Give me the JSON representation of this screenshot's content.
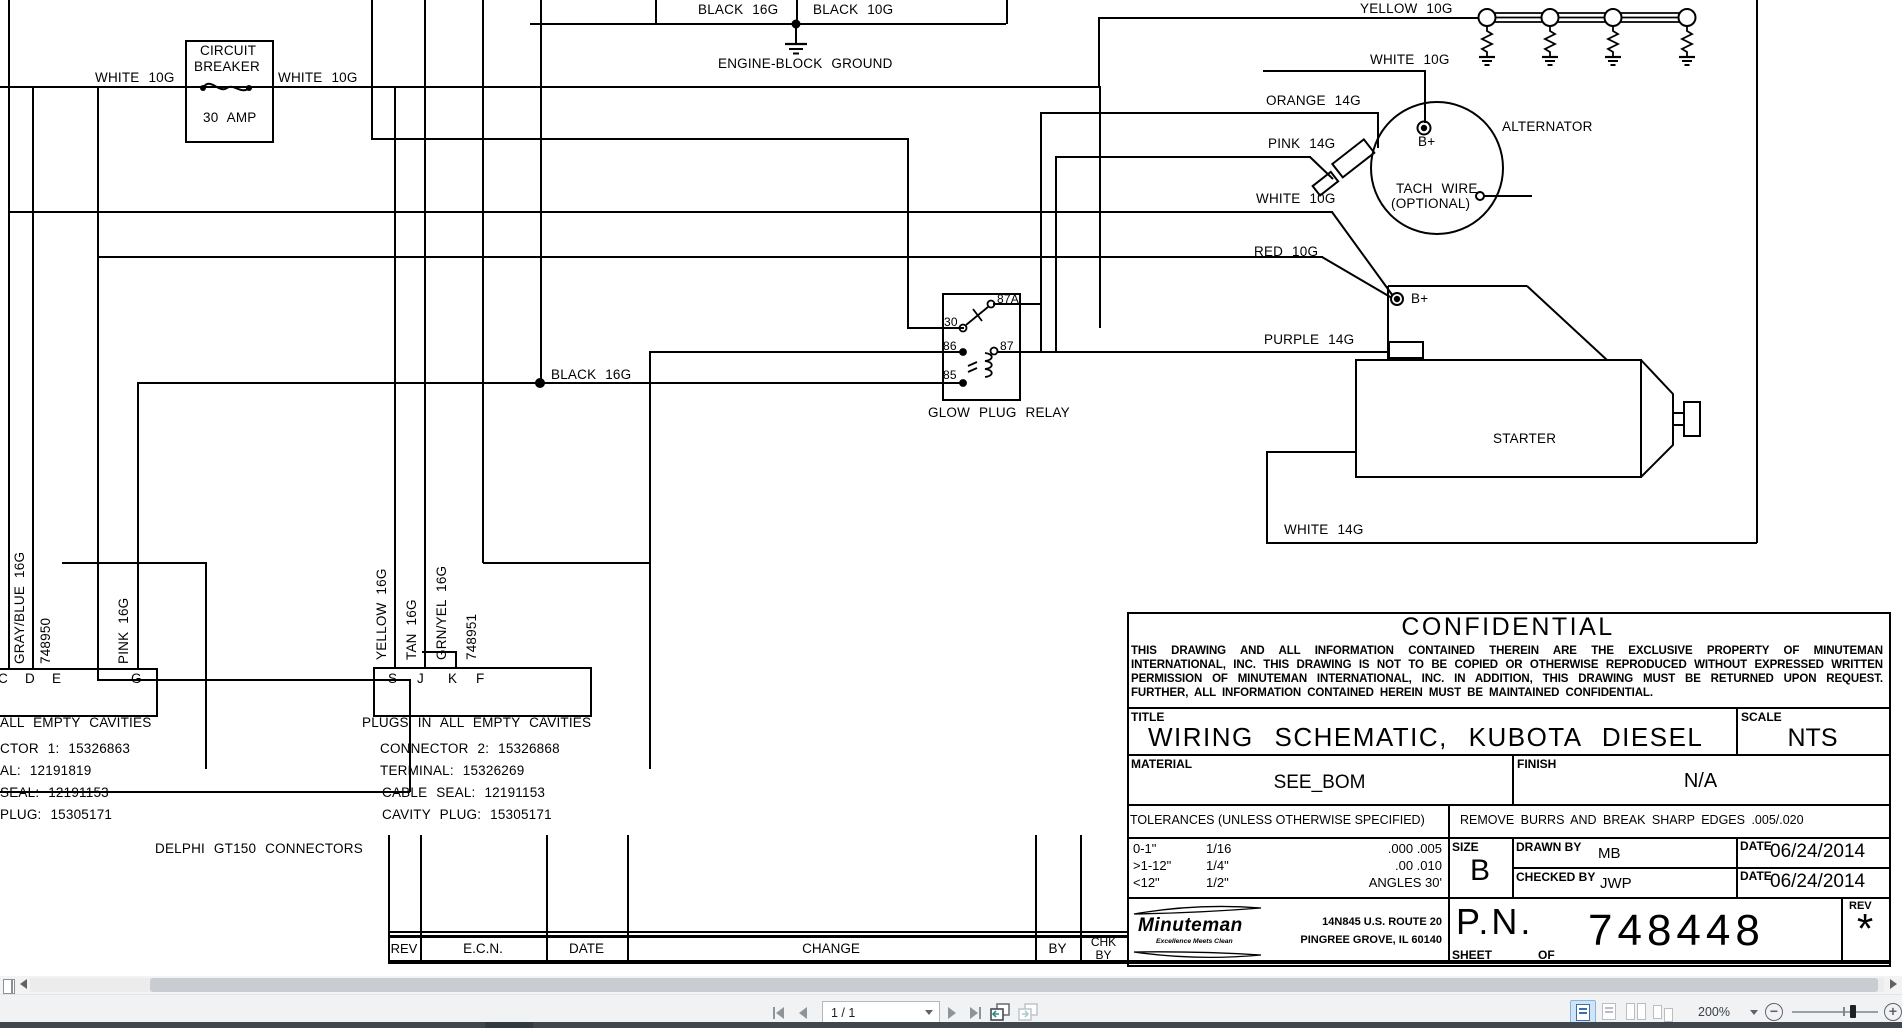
{
  "schematic": {
    "labels": [
      {
        "t": "WHITE 10G",
        "x": 95,
        "y": 69
      },
      {
        "t": "WHITE 10G",
        "x": 278,
        "y": 69
      },
      {
        "t": "CIRCUIT",
        "x": 200,
        "y": 42
      },
      {
        "t": "BREAKER",
        "x": 194,
        "y": 58
      },
      {
        "t": "30 AMP",
        "x": 203,
        "y": 109
      },
      {
        "t": "BLACK 16G",
        "x": 698,
        "y": 1
      },
      {
        "t": "BLACK 10G",
        "x": 813,
        "y": 1
      },
      {
        "t": "ENGINE-BLOCK GROUND",
        "x": 718,
        "y": 55
      },
      {
        "t": "GLOW PLUGS",
        "x": 1531,
        "y": -13
      },
      {
        "t": "YELLOW 10G",
        "x": 1360,
        "y": 0
      },
      {
        "t": "WHITE 10G",
        "x": 1370,
        "y": 51
      },
      {
        "t": "ORANGE 14G",
        "x": 1266,
        "y": 92
      },
      {
        "t": "PINK 14G",
        "x": 1268,
        "y": 135
      },
      {
        "t": "ALTERNATOR",
        "x": 1502,
        "y": 118
      },
      {
        "t": "B+",
        "x": 1418,
        "y": 133
      },
      {
        "t": "TACH WIRE",
        "x": 1396,
        "y": 180
      },
      {
        "t": "(OPTIONAL)",
        "x": 1391,
        "y": 195
      },
      {
        "t": "WHITE 10G",
        "x": 1256,
        "y": 190
      },
      {
        "t": "RED 10G",
        "x": 1254,
        "y": 243
      },
      {
        "t": "B+",
        "x": 1411,
        "y": 290
      },
      {
        "t": "PURPLE 14G",
        "x": 1264,
        "y": 331
      },
      {
        "t": "STARTER",
        "x": 1493,
        "y": 430
      },
      {
        "t": "WHITE 14G",
        "x": 1284,
        "y": 521
      },
      {
        "t": "BLACK 16G",
        "x": 551,
        "y": 366
      },
      {
        "t": "GLOW PLUG RELAY",
        "x": 928,
        "y": 404
      },
      {
        "t": "30",
        "x": 944,
        "y": 314,
        "s": 12
      },
      {
        "t": "87A",
        "x": 997,
        "y": 291,
        "s": 12
      },
      {
        "t": "87",
        "x": 1000,
        "y": 338,
        "s": 12
      },
      {
        "t": "86",
        "x": 943,
        "y": 338,
        "s": 12
      },
      {
        "t": "85",
        "x": 943,
        "y": 367,
        "s": 12
      },
      {
        "t": "C",
        "x": -2,
        "y": 670
      },
      {
        "t": "D",
        "x": 25,
        "y": 670
      },
      {
        "t": "E",
        "x": 52,
        "y": 670
      },
      {
        "t": "G",
        "x": 131,
        "y": 670
      },
      {
        "t": "S",
        "x": 388,
        "y": 670
      },
      {
        "t": "J",
        "x": 417,
        "y": 670
      },
      {
        "t": "K",
        "x": 448,
        "y": 670
      },
      {
        "t": "F",
        "x": 476,
        "y": 670
      },
      {
        "t": "ALL EMPTY CAVITIES",
        "x": 0,
        "y": 714
      },
      {
        "t": "CTOR 1: 15326863",
        "x": 0,
        "y": 740
      },
      {
        "t": "AL: 12191819",
        "x": 0,
        "y": 762
      },
      {
        "t": "SEAL: 12191153",
        "x": 0,
        "y": 784
      },
      {
        "t": "PLUG: 15305171",
        "x": 0,
        "y": 806
      },
      {
        "t": "PLUGS IN ALL EMPTY CAVITIES",
        "x": 362,
        "y": 714
      },
      {
        "t": "CONNECTOR 2: 15326868",
        "x": 380,
        "y": 740
      },
      {
        "t": "TERMINAL: 15326269",
        "x": 380,
        "y": 762
      },
      {
        "t": "CABLE SEAL: 12191153",
        "x": 382,
        "y": 784
      },
      {
        "t": "CAVITY PLUG: 15305171",
        "x": 382,
        "y": 806
      },
      {
        "t": "DELPHI GT150 CONNECTORS",
        "x": 155,
        "y": 840
      }
    ],
    "vertical_labels": [
      {
        "t": "GRAY/BLUE 16G",
        "x": 12,
        "y": 664
      },
      {
        "t": "748950",
        "x": 38,
        "y": 664
      },
      {
        "t": "PINK 16G",
        "x": 116,
        "y": 664
      },
      {
        "t": "YELLOW 16G",
        "x": 374,
        "y": 660
      },
      {
        "t": "TAN 16G",
        "x": 404,
        "y": 660
      },
      {
        "t": "GRN/YEL 16G",
        "x": 434,
        "y": 660
      },
      {
        "t": "748951",
        "x": 464,
        "y": 660
      }
    ]
  },
  "title_block": {
    "confidential_heading": "CONFIDENTIAL",
    "confidential_line1": "THIS DRAWING AND ALL INFORMATION CONTAINED THEREIN ARE THE EXCLUSIVE PROPERTY OF MINUTEMAN",
    "confidential_line2": "INTERNATIONAL, INC. THIS DRAWING IS NOT TO BE COPIED OR OTHERWISE REPRODUCED WITHOUT EXPRESSED WRITTEN",
    "confidential_line3": "PERMISSION OF MINUTEMAN INTERNATIONAL, INC. IN ADDITION, THIS DRAWING MUST BE RETURNED UPON REQUEST.",
    "confidential_line4": "FURTHER, ALL INFORMATION CONTAINED HEREIN MUST BE MAINTAINED CONFIDENTIAL.",
    "title_label": "TITLE",
    "title": "WIRING SCHEMATIC, KUBOTA DIESEL",
    "scale_label": "SCALE",
    "scale": "NTS",
    "material_label": "MATERIAL",
    "material": "SEE_BOM",
    "finish_label": "FINISH",
    "finish": "N/A",
    "tolerances_label": "TOLERANCES (UNLESS OTHERWISE SPECIFIED)",
    "remove_burrs": "REMOVE BURRS AND BREAK SHARP EDGES .005/.020",
    "tol_rows": [
      [
        "0-1\"",
        "1/16",
        ".000  .005"
      ],
      [
        ">1-12\"",
        "1/4\"",
        ".00  .010"
      ],
      [
        "<12\"",
        "1/2\"",
        "ANGLES  30'"
      ]
    ],
    "size_label": "SIZE",
    "size": "B",
    "drawn_by_label": "DRAWN BY",
    "drawn_by": "MB",
    "checked_by_label": "CHECKED BY",
    "checked_by": "JWP",
    "date_label": "DATE",
    "drawn_date": "06/24/2014",
    "checked_date": "06/24/2014",
    "company": "Minuteman",
    "tagline": "Excellence Meets Clean",
    "address_line1": "14N845 U.S. ROUTE 20",
    "address_line2": "PINGREE GROVE, IL 60140",
    "pn_label": "P.N.",
    "part_number": "748448",
    "sheet_label": "SHEET",
    "of_label": "OF",
    "rev_label": "REV",
    "rev": "*"
  },
  "rev_table": {
    "rev": "REV",
    "ecn": "E.C.N.",
    "date": "DATE",
    "change": "CHANGE",
    "by": "BY",
    "chk": "CHK",
    "chk_by": "BY"
  },
  "toolbar": {
    "page_display": "1 / 1",
    "zoom_display": "200%"
  },
  "colors": {
    "line": "#000000",
    "accent_blue": "#cfe4f7",
    "toolbar_bg": "#f1f2f3",
    "bottom_strip": "#3f474c"
  }
}
